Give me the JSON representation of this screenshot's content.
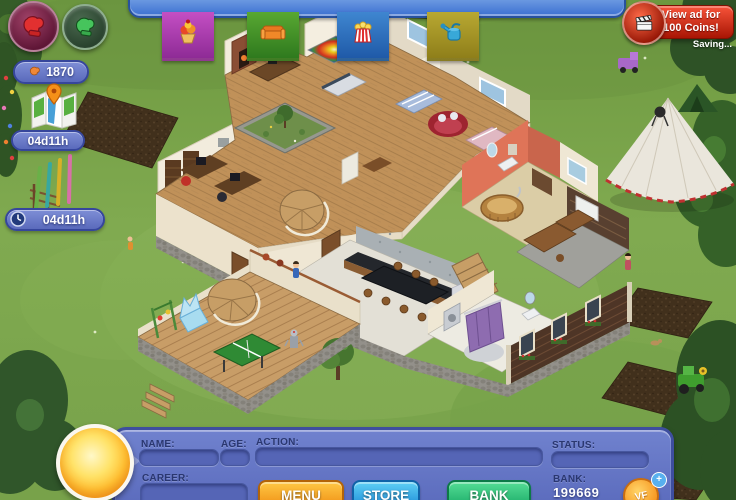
{
  "window": {
    "title": "Virtual Families style life-sim game",
    "width": 736,
    "height": 500
  },
  "hud": {
    "gloves_count": "1870",
    "map_time": "04d11h",
    "timer": "04d11h",
    "icons": [
      "red-hand-icon",
      "green-hand-icon",
      "orange-glove-icon",
      "map-icon",
      "clock-icon"
    ]
  },
  "shop_banners": [
    {
      "name": "treats",
      "icon": "sundae-icon",
      "color": "#a93fb4"
    },
    {
      "name": "furniture",
      "icon": "couch-icon",
      "color": "#3f9b33"
    },
    {
      "name": "popcorn",
      "icon": "popcorn-icon",
      "color": "#2f6fb5"
    },
    {
      "name": "garden",
      "icon": "watering-can-icon",
      "color": "#a79b2f"
    }
  ],
  "ad_button": {
    "line1": "View ad for",
    "line2": "100 Coins!",
    "status": "Saving...",
    "icon": "clapperboard-icon",
    "color": "#c01c08"
  },
  "info_panel": {
    "name_label": "NAME:",
    "name_value": "",
    "age_label": "AGE:",
    "age_value": "",
    "action_label": "ACTION:",
    "action_value": "",
    "status_label": "STATUS:",
    "status_value": "",
    "career_label": "CAREER:",
    "career_value": "",
    "bank_label": "BANK:",
    "bank_value": "199669",
    "buttons": {
      "menu": "MENU",
      "store": "STORE",
      "bank": "BANK"
    },
    "coin": {
      "text": "VF",
      "plus": "+"
    },
    "panel_color": "#6173c4"
  },
  "colors": {
    "grass": "#7aa44c",
    "panel_blue": "#6173c4",
    "menu_orange": "#f5a01c",
    "store_blue": "#2e9de0",
    "bank_green": "#27bd78",
    "ad_red": "#c01c08",
    "badge_blue": "#6b7ccb",
    "wood_floor": "#c09159"
  }
}
